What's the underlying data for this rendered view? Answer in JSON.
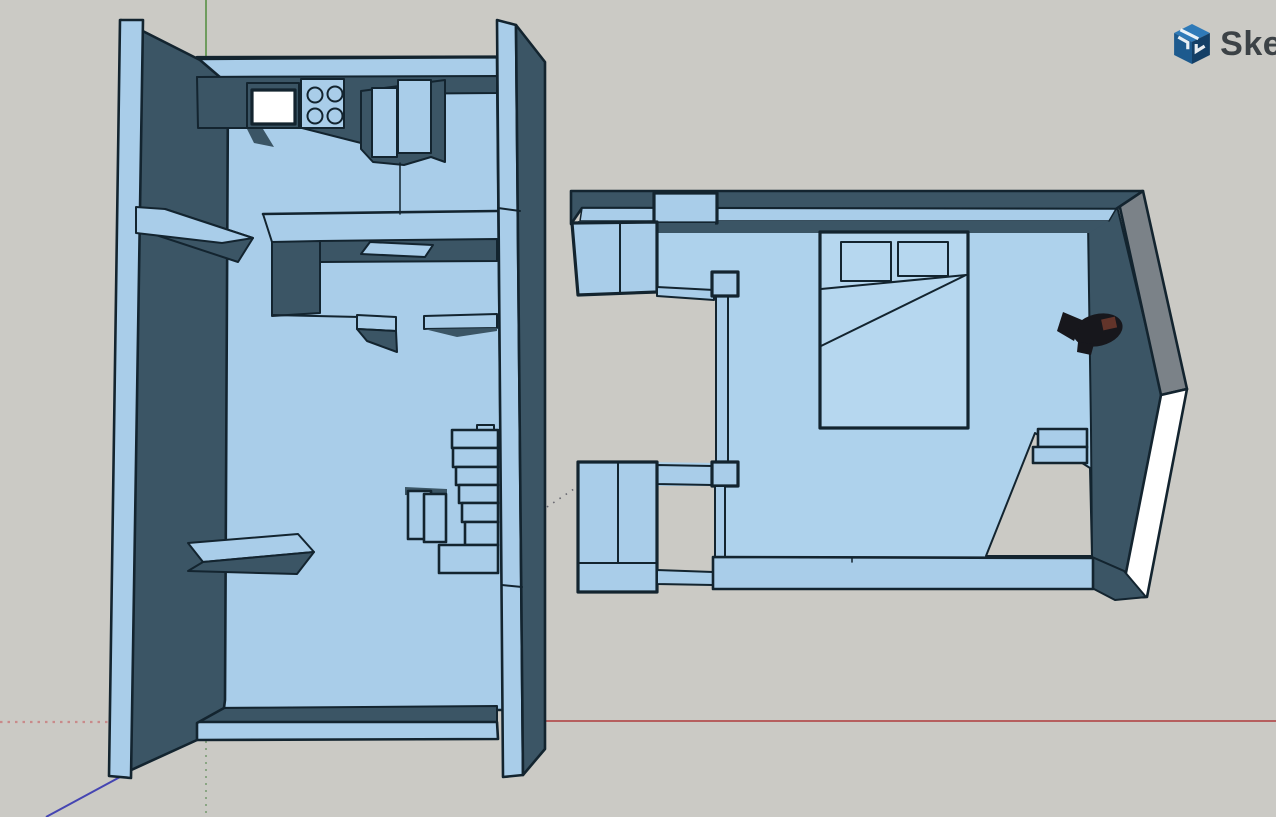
{
  "app": {
    "logo_text": "Sket"
  },
  "colors": {
    "bg": "#cbcac5",
    "face-light": "#a9cde9",
    "face-light2": "#aed2ec",
    "face-bed": "#b6d7ef",
    "face-dark": "#3b5565",
    "face-gray": "#7b8288",
    "face-white": "#ffffff",
    "edge": "#13242f",
    "axis-red": "#b65f5f",
    "axis-red-dim": "#c98a8a",
    "axis-green": "#6f9c5e",
    "axis-green-dim": "#8aa583",
    "axis-blue": "#4545b2",
    "axis-blue-dim": "#54545e",
    "logo-blue-top": "#2f7ab8",
    "logo-blue-left": "#1d5a8e",
    "logo-blue-right": "#143f66",
    "logo-text": "#3c4246"
  }
}
